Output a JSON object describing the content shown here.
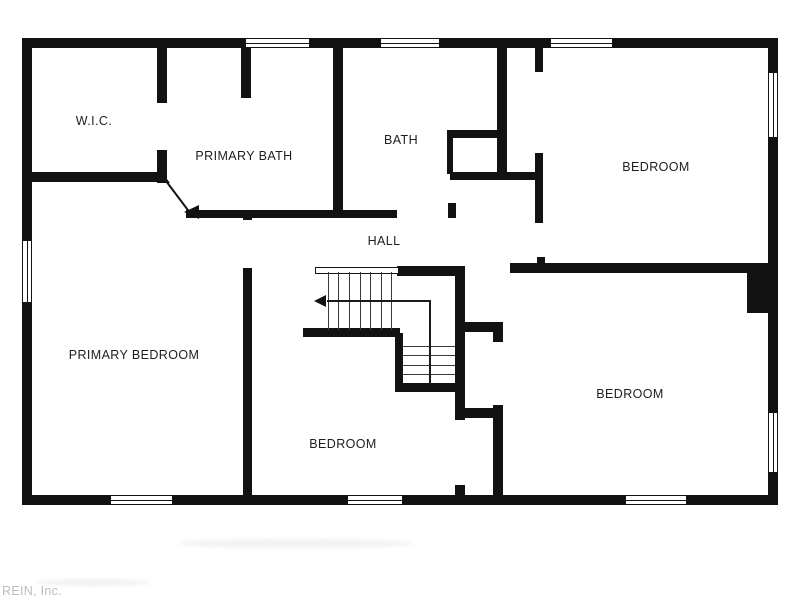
{
  "watermark": {
    "text": "REIN, Inc."
  },
  "colors": {
    "wall": "#121212",
    "background": "#ffffff",
    "label": "#1e1e1e",
    "watermark": "#bcbcbc"
  },
  "rooms": [
    {
      "id": "wic",
      "label": "W.I.C.",
      "cx": 94,
      "cy": 121
    },
    {
      "id": "primary-bath",
      "label": "PRIMARY BATH",
      "cx": 244,
      "cy": 156
    },
    {
      "id": "bath",
      "label": "BATH",
      "cx": 401,
      "cy": 140
    },
    {
      "id": "bedroom-ne",
      "label": "BEDROOM",
      "cx": 656,
      "cy": 167
    },
    {
      "id": "hall",
      "label": "HALL",
      "cx": 384,
      "cy": 241
    },
    {
      "id": "primary-bedroom",
      "label": "PRIMARY BEDROOM",
      "cx": 134,
      "cy": 355
    },
    {
      "id": "bedroom-s",
      "label": "BEDROOM",
      "cx": 343,
      "cy": 444
    },
    {
      "id": "bedroom-se",
      "label": "BEDROOM",
      "cx": 630,
      "cy": 394
    }
  ],
  "walls": [
    {
      "id": "exterior-top",
      "x": 22,
      "y": 38,
      "w": 756,
      "h": 10
    },
    {
      "id": "exterior-left",
      "x": 22,
      "y": 38,
      "w": 10,
      "h": 467
    },
    {
      "id": "exterior-right",
      "x": 768,
      "y": 38,
      "w": 10,
      "h": 467
    },
    {
      "id": "exterior-bottom",
      "x": 22,
      "y": 495,
      "w": 756,
      "h": 10
    },
    {
      "id": "wic-right-upper",
      "x": 157,
      "y": 48,
      "w": 10,
      "h": 55
    },
    {
      "id": "wic-right-lower",
      "x": 157,
      "y": 150,
      "w": 10,
      "h": 30
    },
    {
      "id": "wic-bottom",
      "x": 22,
      "y": 172,
      "w": 140,
      "h": 10
    },
    {
      "id": "bath-shower-stub",
      "x": 241,
      "y": 48,
      "w": 10,
      "h": 50
    },
    {
      "id": "primarybath-bath-divider",
      "x": 333,
      "y": 48,
      "w": 10,
      "h": 164
    },
    {
      "id": "hall-top",
      "x": 186,
      "y": 210,
      "w": 211,
      "h": 8
    },
    {
      "id": "bath-nook-top",
      "x": 447,
      "y": 130,
      "w": 52,
      "h": 8
    },
    {
      "id": "bath-nook-left",
      "x": 447,
      "y": 138,
      "w": 6,
      "h": 36
    },
    {
      "id": "bath-right",
      "x": 497,
      "y": 48,
      "w": 10,
      "h": 126
    },
    {
      "id": "closet-bottom-wall",
      "x": 450,
      "y": 172,
      "w": 93,
      "h": 8
    },
    {
      "id": "hall-stub",
      "x": 448,
      "y": 203,
      "w": 8,
      "h": 15
    },
    {
      "id": "ne-bedroom-left-upper",
      "x": 535,
      "y": 48,
      "w": 8,
      "h": 24
    },
    {
      "id": "ne-bedroom-left-lower",
      "x": 535,
      "y": 153,
      "w": 8,
      "h": 70
    },
    {
      "id": "ne-bedroom-nub",
      "x": 537,
      "y": 257,
      "w": 8,
      "h": 6
    },
    {
      "id": "right-bedrooms-divider",
      "x": 510,
      "y": 263,
      "w": 258,
      "h": 10
    },
    {
      "id": "stairs-top-wall",
      "x": 397,
      "y": 266,
      "w": 66,
      "h": 10
    },
    {
      "id": "stairs-bottom-wall",
      "x": 303,
      "y": 328,
      "w": 97,
      "h": 9
    },
    {
      "id": "stairs-lower-left",
      "x": 395,
      "y": 333,
      "w": 8,
      "h": 59
    },
    {
      "id": "stairs-lower-bottom",
      "x": 395,
      "y": 383,
      "w": 68,
      "h": 9
    },
    {
      "id": "stairwell-right",
      "x": 455,
      "y": 266,
      "w": 10,
      "h": 154
    },
    {
      "id": "closet-se-top",
      "x": 458,
      "y": 322,
      "w": 45,
      "h": 10
    },
    {
      "id": "closet-se-bottom",
      "x": 458,
      "y": 408,
      "w": 45,
      "h": 10
    },
    {
      "id": "closet-se-right-nub",
      "x": 493,
      "y": 328,
      "w": 10,
      "h": 14
    },
    {
      "id": "se-bedroom-left",
      "x": 493,
      "y": 405,
      "w": 10,
      "h": 90
    },
    {
      "id": "s-bedroom-door-nub",
      "x": 455,
      "y": 485,
      "w": 10,
      "h": 12
    },
    {
      "id": "primary-hall-nub",
      "x": 243,
      "y": 210,
      "w": 9,
      "h": 10
    },
    {
      "id": "primary-s-divider",
      "x": 243,
      "y": 268,
      "w": 9,
      "h": 237
    },
    {
      "id": "chimney",
      "x": 747,
      "y": 271,
      "w": 30,
      "h": 42
    }
  ],
  "windows": [
    {
      "id": "top-window-1",
      "x": 245,
      "y": 38,
      "w": 65,
      "h": 10,
      "orient": "h"
    },
    {
      "id": "top-window-2",
      "x": 380,
      "y": 38,
      "w": 60,
      "h": 10,
      "orient": "h"
    },
    {
      "id": "top-window-3",
      "x": 550,
      "y": 38,
      "w": 63,
      "h": 10,
      "orient": "h"
    },
    {
      "id": "left-window-1",
      "x": 22,
      "y": 240,
      "w": 10,
      "h": 63,
      "orient": "v"
    },
    {
      "id": "right-window-1",
      "x": 768,
      "y": 72,
      "w": 10,
      "h": 66,
      "orient": "v"
    },
    {
      "id": "right-window-2",
      "x": 768,
      "y": 412,
      "w": 10,
      "h": 61,
      "orient": "v"
    },
    {
      "id": "bottom-window-1",
      "x": 110,
      "y": 495,
      "w": 63,
      "h": 10,
      "orient": "h"
    },
    {
      "id": "bottom-window-2",
      "x": 347,
      "y": 495,
      "w": 56,
      "h": 10,
      "orient": "h"
    },
    {
      "id": "bottom-window-3",
      "x": 625,
      "y": 495,
      "w": 62,
      "h": 10,
      "orient": "h"
    }
  ],
  "stairs": {
    "top_edge": {
      "x": 315,
      "y": 267,
      "w": 84,
      "h": 7
    },
    "upper_flight": {
      "x": 317,
      "y": 272,
      "w": 85,
      "h": 58,
      "treads": 7,
      "orient": "v"
    },
    "lower_flight": {
      "x": 403,
      "y": 337,
      "w": 52,
      "h": 46,
      "treads": 4,
      "orient": "h"
    },
    "run_line": {
      "x": 327,
      "y": 300,
      "len": 103
    },
    "turn_line": {
      "x": 429,
      "y": 300,
      "len": 84
    }
  },
  "diagonal_wall": {
    "x": 165,
    "y": 178,
    "len": 42,
    "angle": 53
  },
  "triangles": [
    {
      "id": "wic-wall-cap",
      "x": 157,
      "y": 166,
      "w": 13,
      "h": 17,
      "dir": "se"
    },
    {
      "id": "hall-wall-cap",
      "x": 184,
      "y": 205,
      "w": 15,
      "h": 14,
      "dir": "left"
    },
    {
      "id": "stair-direction-arrow",
      "x": 314,
      "y": 295,
      "w": 12,
      "h": 12,
      "dir": "left"
    }
  ],
  "smudges": [
    {
      "x": 177,
      "y": 539,
      "w": 236,
      "h": 9
    },
    {
      "x": 35,
      "y": 579,
      "w": 115,
      "h": 7
    }
  ]
}
